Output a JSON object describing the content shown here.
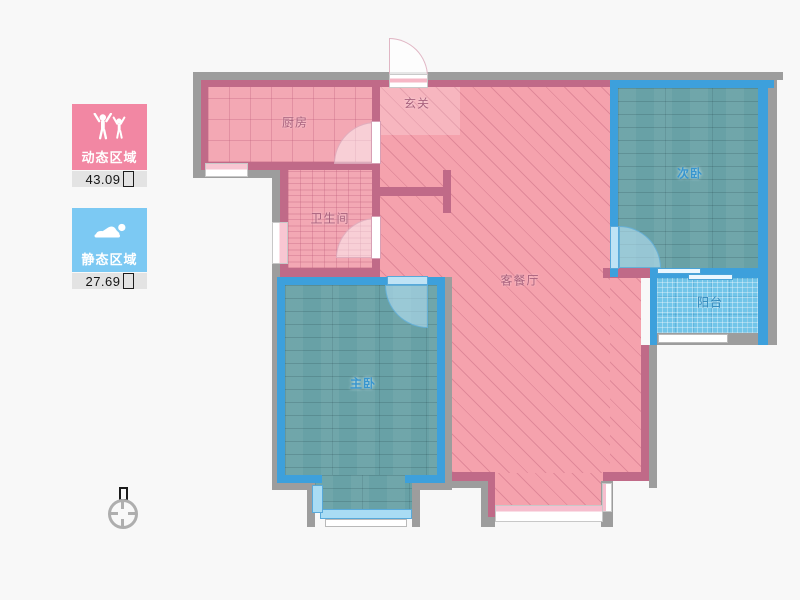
{
  "legend": {
    "dynamic": {
      "label": "动态区域",
      "value": "43.09",
      "unit": "㎡",
      "color": "#f287a3",
      "icon": "people-arms-up-icon"
    },
    "static": {
      "label": "静态区域",
      "value": "27.69",
      "unit": "㎡",
      "color": "#7cc9f3",
      "icon": "person-lying-icon"
    }
  },
  "rooms": {
    "kitchen": {
      "label": "厨房",
      "zone": "dynamic"
    },
    "entry": {
      "label": "玄关",
      "zone": "dynamic"
    },
    "bathroom": {
      "label": "卫生间",
      "zone": "dynamic"
    },
    "living_dining": {
      "label": "客餐厅",
      "zone": "dynamic"
    },
    "master_bedroom": {
      "label": "主卧",
      "zone": "static"
    },
    "second_bedroom": {
      "label": "次卧",
      "zone": "static"
    },
    "balcony": {
      "label": "阳台",
      "zone": "static"
    }
  },
  "colors": {
    "dynamic_fill": "#f5a2ad",
    "dynamic_wall": "#c06a88",
    "static_wall": "#3da0dc",
    "static_floor": "#68a1a6",
    "balcony_fill": "#72c5e9",
    "outer_wall": "#9d9d9d",
    "background": "#f8f8f8",
    "legend_dynamic": "#f287a3",
    "legend_static": "#7cc9f3"
  }
}
